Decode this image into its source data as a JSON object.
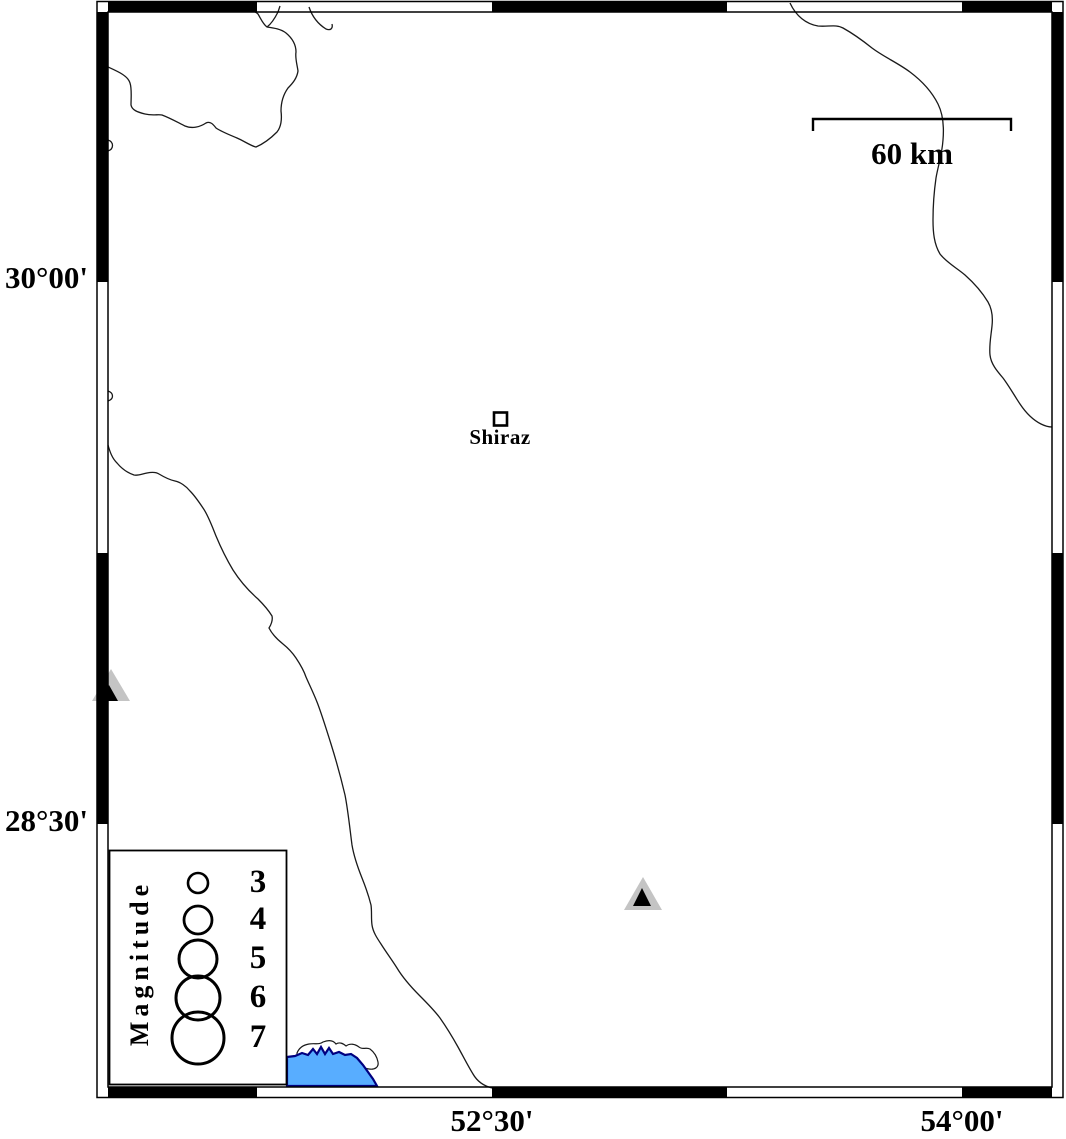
{
  "frame": {
    "axis_left": [
      {
        "label": "30°00'"
      },
      {
        "label": "28°30'"
      }
    ],
    "axis_bottom": [
      {
        "label": "52°30'"
      },
      {
        "label": "54°00'"
      }
    ]
  },
  "scale_bar": {
    "label": "60 km"
  },
  "city": {
    "label": "Shiraz"
  },
  "legend": {
    "title": "Magnitude",
    "sizes": [
      {
        "label": "3"
      },
      {
        "label": "4"
      },
      {
        "label": "5"
      },
      {
        "label": "6"
      },
      {
        "label": "7"
      }
    ]
  },
  "colors": {
    "water": "#58ADFF",
    "water_edge": "#000080",
    "station_fill": "#C4C4C4",
    "station_core": "#000000",
    "line": "#1a1a1a"
  }
}
